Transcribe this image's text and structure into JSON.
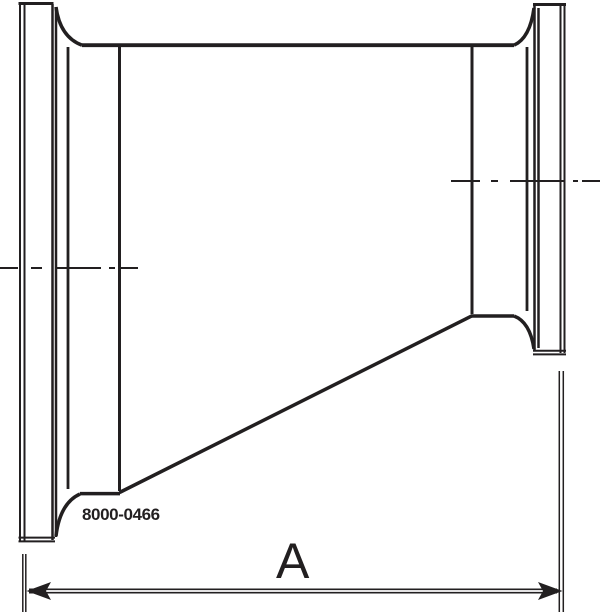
{
  "drawing": {
    "part_number": "8000-0466",
    "dimension_label": "A",
    "line_color": "#221f20",
    "background_color": "#ffffff"
  }
}
